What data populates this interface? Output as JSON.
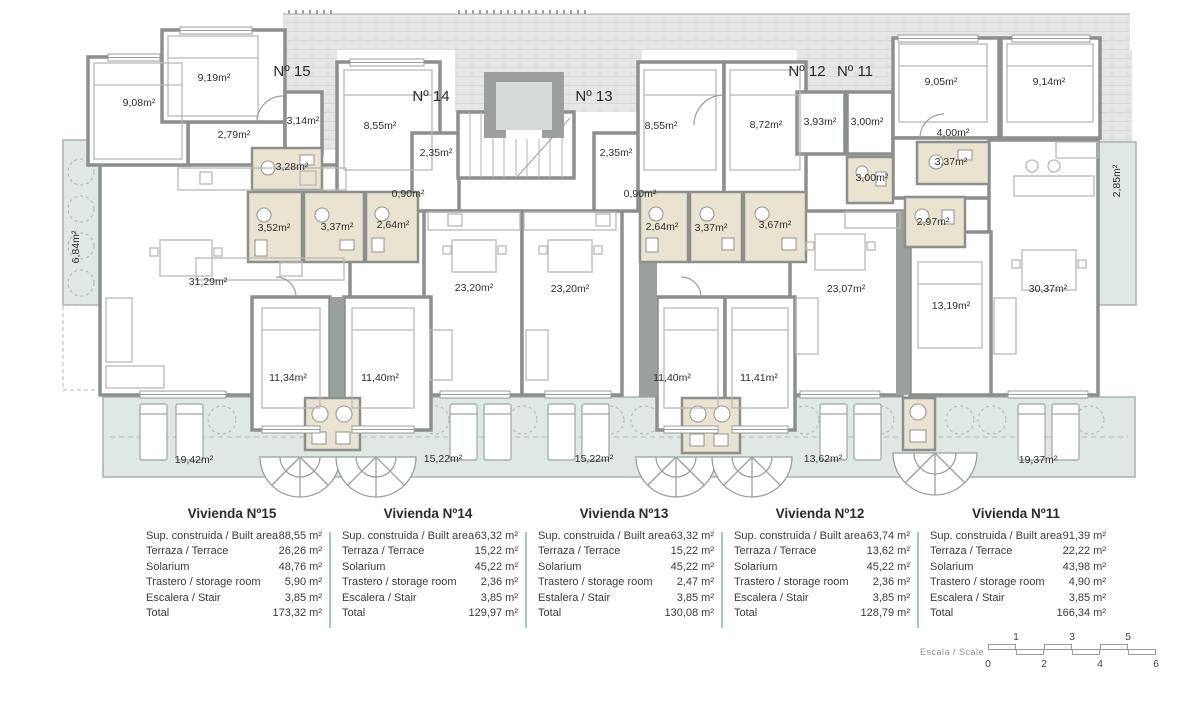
{
  "plan": {
    "units": {
      "u15": "Nº 15",
      "u14": "Nº 14",
      "u13": "Nº 13",
      "u12": "Nº 12",
      "u11": "Nº 11"
    },
    "rooms": {
      "balcony_left": "6,84m²",
      "u15_bed1": "9,08m²",
      "u15_bed2": "9,19m²",
      "u15_hall": "2,79m²",
      "u15_closet": "3,14m²",
      "u15_bath1": "3,28m²",
      "u15_bath2": "3,52m²",
      "u15_bath3": "3,37m²",
      "u15_living": "31,29m²",
      "u15_bed3": "11,34m²",
      "u15_bed4": "11,40m²",
      "u14_bed": "8,55m²",
      "u14_closet": "2,35m²",
      "u14_hall": "0,90m²",
      "u14_bath": "2,64m²",
      "u14_living": "23,20m²",
      "u13_living": "23,20m²",
      "u13_closet": "2,35m²",
      "u13_bed": "8,55m²",
      "u13_hall": "0,90m²",
      "u13_bath1": "2,64m²",
      "u13_bath2": "3,37m²",
      "u13_bed2": "11,40m²",
      "u12_bed": "8,72m²",
      "u12_closet1": "3,93m²",
      "u12_closet2": "3,00m²",
      "u12_bath2": "3,00m²",
      "u12_bath": "3,67m²",
      "u12_living": "23,07m²",
      "u12_bed2": "11,41m²",
      "u11_bed1": "9,05m²",
      "u11_bed2": "9,14m²",
      "u11_hall": "4,00m²",
      "u11_bath1": "3,37m²",
      "u11_bath2": "2,97m²",
      "u11_bed3": "13,19m²",
      "u11_living": "30,37m²",
      "balcony_right": "2,85m²",
      "terrace_15": "19,42m²",
      "terrace_14": "15,22m²",
      "terrace_13": "15,22m²",
      "terrace_12": "13,62m²",
      "terrace_11": "19,37m²"
    }
  },
  "tables": [
    {
      "title": "Vivienda Nº15",
      "rows": [
        {
          "label": "Sup. construida / Built area",
          "value": "88,55 m²"
        },
        {
          "label": "Terraza / Terrace",
          "value": "26,26 m²"
        },
        {
          "label": "Solarium",
          "value": "48,76 m²"
        },
        {
          "label": "Trastero / storage room",
          "value": "5,90 m²"
        },
        {
          "label": "Escalera / Stair",
          "value": "3,85 m²"
        },
        {
          "label": "Total",
          "value": "173,32 m²"
        }
      ]
    },
    {
      "title": "Vivienda Nº14",
      "rows": [
        {
          "label": "Sup. construida / Built area",
          "value": "63,32 m²"
        },
        {
          "label": "Terraza / Terrace",
          "value": "15,22 m²"
        },
        {
          "label": "Solarium",
          "value": "45,22 m²"
        },
        {
          "label": "Trastero / storage room",
          "value": "2,36 m²"
        },
        {
          "label": "Escalera / Stair",
          "value": "3,85 m²"
        },
        {
          "label": "Total",
          "value": "129,97 m²"
        }
      ]
    },
    {
      "title": "Vivienda Nº13",
      "rows": [
        {
          "label": "Sup. construida / Built area",
          "value": "63,32 m²"
        },
        {
          "label": "Terraza / Terrace",
          "value": "15,22 m²"
        },
        {
          "label": "Solarium",
          "value": "45,22 m²"
        },
        {
          "label": "Trastero / storage room",
          "value": "2,47 m²"
        },
        {
          "label": "Estalera / Stair",
          "value": "3,85 m²"
        },
        {
          "label": "Total",
          "value": "130,08 m²"
        }
      ]
    },
    {
      "title": "Vivienda Nº12",
      "rows": [
        {
          "label": "Sup. construida / Built area",
          "value": "63,74 m²"
        },
        {
          "label": "Terraza / Terrace",
          "value": "13,62 m²"
        },
        {
          "label": "Solarium",
          "value": "45,22 m²"
        },
        {
          "label": "Trastero / storage room",
          "value": "2,36 m²"
        },
        {
          "label": "Escalera / Stair",
          "value": "3,85 m²"
        },
        {
          "label": "Total",
          "value": "128,79 m²"
        }
      ]
    },
    {
      "title": "Vivienda Nº11",
      "rows": [
        {
          "label": "Sup. construida / Built area",
          "value": "91,39 m²"
        },
        {
          "label": "Terraza / Terrace",
          "value": "22,22 m²"
        },
        {
          "label": "Solarium",
          "value": "43,98 m²"
        },
        {
          "label": "Trastero / storage room",
          "value": "4,90 m²"
        },
        {
          "label": "Escalera / Stair",
          "value": "3,85 m²"
        },
        {
          "label": "Total",
          "value": "166,34 m²"
        }
      ]
    }
  ],
  "scale": {
    "label": "Escala / Scale",
    "top_ticks": [
      "1",
      "3",
      "5"
    ],
    "bottom_ticks": [
      "0",
      "2",
      "4",
      "6"
    ]
  },
  "colors": {
    "wall": "#8b8f8d",
    "roof": "#e4e7e5",
    "terrace": "#dfe8e3",
    "bath_floor": "#e9e3cf",
    "table_divider": "#9dc9b6"
  }
}
